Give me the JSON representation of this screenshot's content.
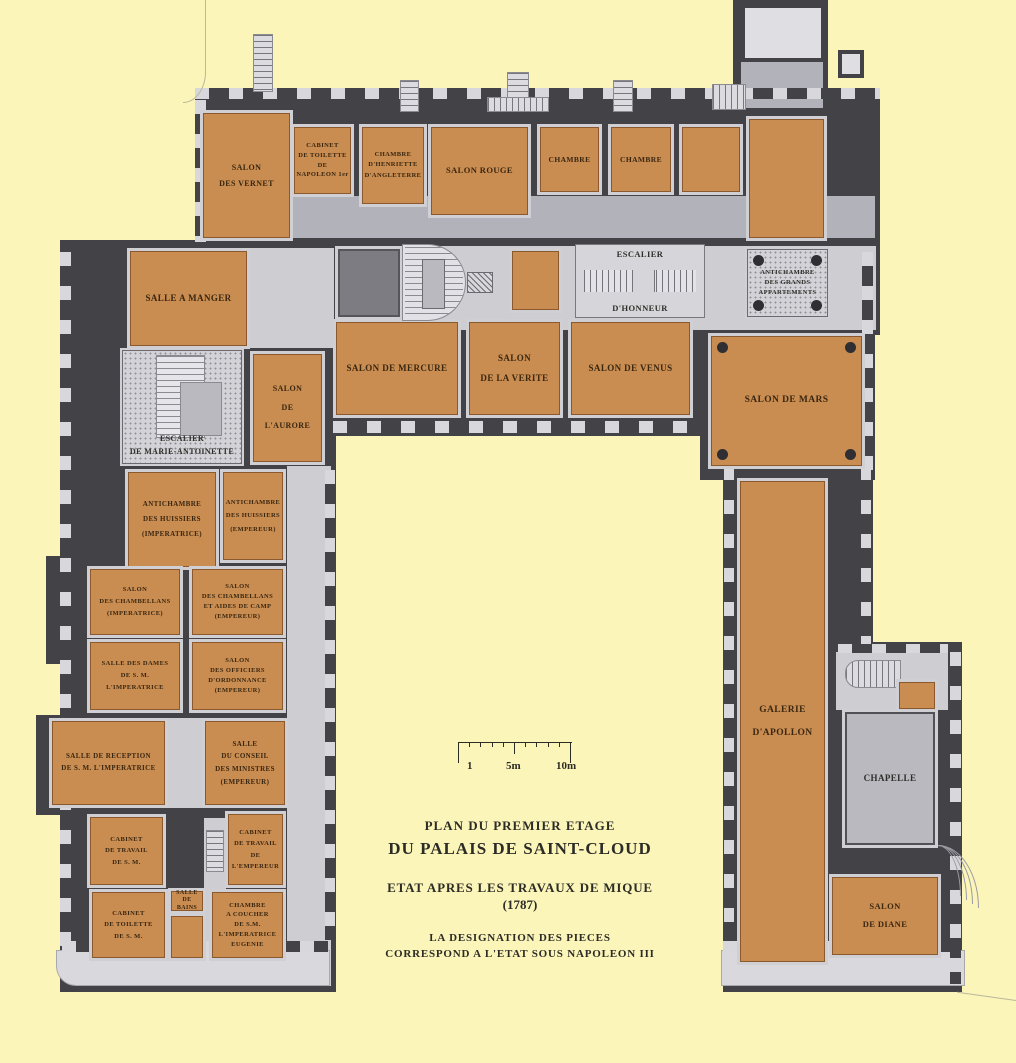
{
  "colors": {
    "background": "#fbf5ba",
    "wall": "#424247",
    "room_orange": "#c98c51",
    "room_border": "#8a5a2e",
    "floor_light": "#cdcdd2",
    "label_text": "#3a2710"
  },
  "title_block": {
    "lines": [
      "PLAN DU PREMIER ETAGE",
      "DU PALAIS DE SAINT-CLOUD",
      "ETAT APRES LES TRAVAUX DE MIQUE",
      "(1787)",
      "LA DESIGNATION DES PIECES",
      "CORRESPOND A L'ETAT SOUS NAPOLEON III"
    ]
  },
  "scalebar": {
    "labels": [
      "1",
      "5m",
      "10m"
    ]
  },
  "rooms": [
    {
      "id": "salon-des-vernet",
      "type": "orange",
      "x": 203,
      "y": 113,
      "w": 87,
      "h": 125,
      "fs": 8,
      "lh": 1.9,
      "lines": [
        "SALON",
        "DES VERNET"
      ]
    },
    {
      "id": "cabinet-de-toilette-de-napoleon-1er",
      "type": "orange",
      "x": 294,
      "y": 127,
      "w": 57,
      "h": 67,
      "fs": 6.5,
      "lh": 1.5,
      "lines": [
        "CABINET",
        "DE TOILETTE",
        "DE",
        "NAPOLEON 1er"
      ]
    },
    {
      "id": "chambre-d-henriette-d-angleterre",
      "type": "orange",
      "x": 362,
      "y": 127,
      "w": 62,
      "h": 77,
      "fs": 6.5,
      "lh": 1.6,
      "lines": [
        "CHAMBRE",
        "D'HENRIETTE",
        "D'ANGLETERRE"
      ]
    },
    {
      "id": "salon-rouge",
      "type": "orange",
      "x": 431,
      "y": 127,
      "w": 97,
      "h": 88,
      "fs": 8.5,
      "lh": 1.6,
      "lines": [
        "SALON ROUGE"
      ]
    },
    {
      "id": "chambre-1",
      "type": "orange",
      "x": 540,
      "y": 127,
      "w": 59,
      "h": 65,
      "fs": 7.5,
      "lh": 1.6,
      "lines": [
        "CHAMBRE"
      ]
    },
    {
      "id": "chambre-2",
      "type": "orange",
      "x": 611,
      "y": 127,
      "w": 60,
      "h": 65,
      "fs": 7.5,
      "lh": 1.6,
      "lines": [
        "CHAMBRE"
      ]
    },
    {
      "id": "room-northeast-1",
      "type": "orange",
      "x": 682,
      "y": 127,
      "w": 58,
      "h": 65,
      "lines": []
    },
    {
      "id": "room-northeast-2",
      "type": "orange",
      "x": 749,
      "y": 119,
      "w": 75,
      "h": 119,
      "lines": []
    },
    {
      "id": "room-center-small",
      "type": "orange",
      "x": 512,
      "y": 251,
      "w": 47,
      "h": 59,
      "lines": []
    },
    {
      "id": "salle-a-manger",
      "type": "orange",
      "x": 130,
      "y": 251,
      "w": 117,
      "h": 95,
      "fs": 9,
      "lh": 1.6,
      "lines": [
        "SALLE A MANGER"
      ]
    },
    {
      "id": "salon-de-l-aurore",
      "type": "orange",
      "x": 253,
      "y": 354,
      "w": 69,
      "h": 108,
      "fs": 8,
      "lh": 2.3,
      "lines": [
        "SALON",
        "DE",
        "L'AURORE"
      ]
    },
    {
      "id": "salon-de-mercure",
      "type": "orange",
      "x": 336,
      "y": 322,
      "w": 122,
      "h": 93,
      "fs": 9,
      "lh": 1.6,
      "lines": [
        "SALON DE MERCURE"
      ]
    },
    {
      "id": "salon-de-la-verite",
      "type": "orange",
      "x": 469,
      "y": 322,
      "w": 91,
      "h": 93,
      "fs": 9,
      "lh": 2.2,
      "lines": [
        "SALON",
        "DE LA VERITE"
      ]
    },
    {
      "id": "salon-de-venus",
      "type": "orange",
      "x": 571,
      "y": 322,
      "w": 119,
      "h": 93,
      "fs": 9,
      "lh": 1.6,
      "lines": [
        "SALON DE VENUS"
      ]
    },
    {
      "id": "salon-de-mars",
      "type": "orange",
      "x": 711,
      "y": 336,
      "w": 151,
      "h": 130,
      "fs": 9.5,
      "lh": 1.6,
      "dots": true,
      "lines": [
        "SALON DE MARS"
      ]
    },
    {
      "id": "antichambre-des-huissiers-imperatrice",
      "type": "orange",
      "x": 128,
      "y": 472,
      "w": 88,
      "h": 95,
      "fs": 7,
      "lh": 2.1,
      "lines": [
        "ANTICHAMBRE",
        "DES HUISSIERS",
        "(IMPERATRICE)"
      ]
    },
    {
      "id": "antichambre-des-huissiers-empereur",
      "type": "orange",
      "x": 223,
      "y": 472,
      "w": 60,
      "h": 88,
      "fs": 6.5,
      "lh": 2.1,
      "lines": [
        "ANTICHAMBRE",
        "DES HUISSIERS",
        "(EMPEREUR)"
      ]
    },
    {
      "id": "salon-des-chambellans-imperatrice",
      "type": "orange",
      "x": 90,
      "y": 569,
      "w": 90,
      "h": 66,
      "fs": 6.5,
      "lh": 1.8,
      "lines": [
        "SALON",
        "DES CHAMBELLANS",
        "(IMPERATRICE)"
      ]
    },
    {
      "id": "salon-des-chambellans-et-aides-de-camp-empereur",
      "type": "orange",
      "x": 192,
      "y": 569,
      "w": 91,
      "h": 66,
      "fs": 6.5,
      "lh": 1.55,
      "lines": [
        "SALON",
        "DES CHAMBELLANS",
        "ET AIDES DE CAMP",
        "(EMPEREUR)"
      ]
    },
    {
      "id": "salle-des-dames-de-s-m-l-imperatrice",
      "type": "orange",
      "x": 90,
      "y": 642,
      "w": 90,
      "h": 68,
      "fs": 6.5,
      "lh": 1.8,
      "lines": [
        "SALLE DES DAMES",
        "DE S. M. L'IMPERATRICE"
      ]
    },
    {
      "id": "salon-des-officiers-d-ordonnance-empereur",
      "type": "orange",
      "x": 192,
      "y": 642,
      "w": 91,
      "h": 68,
      "fs": 6.5,
      "lh": 1.55,
      "lines": [
        "SALON",
        "DES OFFICIERS",
        "D'ORDONNANCE",
        "(EMPEREUR)"
      ]
    },
    {
      "id": "salle-de-reception-de-s-m-l-imperatrice",
      "type": "orange",
      "x": 52,
      "y": 721,
      "w": 113,
      "h": 84,
      "fs": 7,
      "lh": 1.7,
      "lines": [
        "SALLE DE RECEPTION",
        "DE S. M. L'IMPERATRICE"
      ]
    },
    {
      "id": "salle-du-conseil-des-ministres-empereur",
      "type": "orange",
      "x": 205,
      "y": 721,
      "w": 80,
      "h": 84,
      "fs": 7,
      "lh": 1.8,
      "lines": [
        "SALLE",
        "DU CONSEIL",
        "DES MINISTRES",
        "(EMPEREUR)"
      ]
    },
    {
      "id": "cabinet-de-travail-de-s-m",
      "type": "orange",
      "x": 90,
      "y": 817,
      "w": 73,
      "h": 68,
      "fs": 6.5,
      "lh": 1.7,
      "lines": [
        "CABINET",
        "DE TRAVAIL",
        "DE S. M."
      ]
    },
    {
      "id": "cabinet-de-travail-de-l-empereur",
      "type": "orange",
      "x": 228,
      "y": 814,
      "w": 55,
      "h": 71,
      "fs": 6.5,
      "lh": 1.7,
      "lines": [
        "CABINET",
        "DE TRAVAIL",
        "DE",
        "L'EMPEREUR"
      ]
    },
    {
      "id": "salle-de-bains",
      "type": "orange",
      "x": 171,
      "y": 891,
      "w": 32,
      "h": 20,
      "fs": 6,
      "lh": 1.2,
      "lines": [
        "SALLE",
        "DE BAINS"
      ]
    },
    {
      "id": "cabinet-de-toilette-de-s-m",
      "type": "orange",
      "x": 92,
      "y": 892,
      "w": 73,
      "h": 66,
      "fs": 6.5,
      "lh": 1.7,
      "lines": [
        "CABINET",
        "DE TOILETTE",
        "DE S. M."
      ]
    },
    {
      "id": "room-bains-annex",
      "type": "orange",
      "x": 171,
      "y": 916,
      "w": 32,
      "h": 42,
      "lines": []
    },
    {
      "id": "chambre-a-coucher-de-s-m-l-imperatrice-eugenie",
      "type": "orange",
      "x": 212,
      "y": 892,
      "w": 71,
      "h": 66,
      "fs": 6.5,
      "lh": 1.5,
      "lines": [
        "CHAMBRE",
        "A COUCHER",
        "DE S.M.",
        "L'IMPERATRICE",
        "EUGENIE"
      ]
    },
    {
      "id": "galerie-d-apollon",
      "type": "orange",
      "x": 740,
      "y": 481,
      "w": 85,
      "h": 481,
      "fs": 9.5,
      "lh": 2.4,
      "lines": [
        "GALERIE",
        "D'APOLLON"
      ]
    },
    {
      "id": "room-chapelle-annex",
      "type": "orange",
      "x": 899,
      "y": 682,
      "w": 36,
      "h": 27,
      "lines": []
    },
    {
      "id": "salon-de-diane",
      "type": "orange",
      "x": 832,
      "y": 877,
      "w": 106,
      "h": 78,
      "fs": 8.5,
      "lh": 2.1,
      "lines": [
        "SALON",
        "DE DIANE"
      ]
    },
    {
      "id": "escalier-d-honneur",
      "type": "stair-h",
      "x": 575,
      "y": 244,
      "w": 130,
      "h": 74,
      "fs": 8.5,
      "lh": 1.2,
      "lines": [
        "ESCALIER",
        "D'HONNEUR"
      ]
    },
    {
      "id": "antichambre-des-grands-appartements",
      "type": "dotted",
      "x": 747,
      "y": 249,
      "w": 81,
      "h": 68,
      "fs": 6.5,
      "lh": 1.5,
      "dots": true,
      "lines": [
        "ANTICHAMBRE",
        "DES GRANDS",
        "APPARTEMENTS"
      ]
    },
    {
      "id": "escalier-de-marie-antoinette",
      "type": "ma-stair",
      "x": 122,
      "y": 350,
      "w": 120,
      "h": 114,
      "fs": 8,
      "lh": 1.55,
      "lines": [
        "ESCALIER",
        "DE MARIE-ANTOINETTE"
      ]
    },
    {
      "id": "chapelle",
      "type": "gray",
      "x": 845,
      "y": 712,
      "w": 90,
      "h": 133,
      "fs": 9,
      "lh": 1.6,
      "lines": [
        "CHAPELLE"
      ]
    },
    {
      "id": "room-dark-center",
      "type": "darkroom",
      "x": 338,
      "y": 249,
      "w": 62,
      "h": 68,
      "lines": []
    },
    {
      "id": "oval-staircase",
      "type": "oval-stair",
      "x": 402,
      "y": 244,
      "w": 64,
      "h": 77,
      "lines": []
    }
  ]
}
